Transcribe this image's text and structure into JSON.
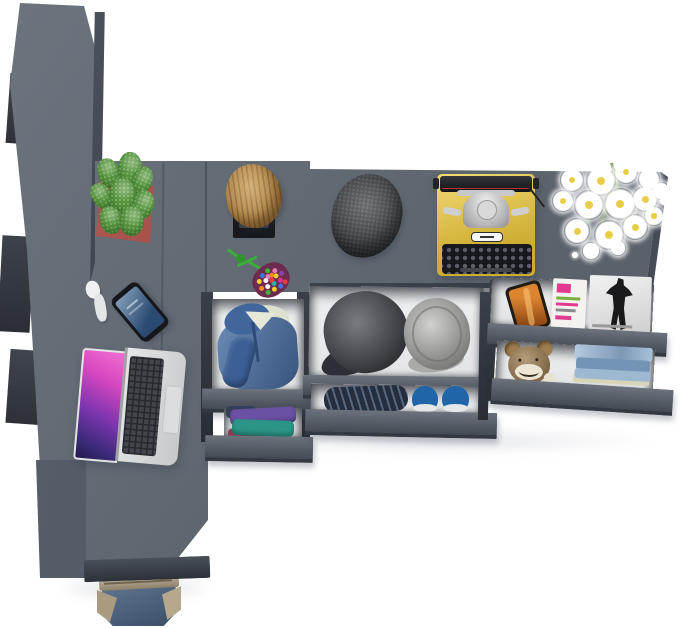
{
  "scene": {
    "type": "3d-furniture-render-top-view",
    "description": "Top-down render of a gray modular wardrobe and desk system with open drawers, clothing and desk accessories",
    "background": "#ffffff"
  },
  "colors": {
    "furniture_top": "#5d6671",
    "furniture_front": "#565e6a",
    "furniture_side": "#454c57",
    "furniture_dark_edge": "#3a414c",
    "drawer_interior": "#eef0f1",
    "typewriter_yellow": "#efc93a",
    "typewriter_keys": "#17191d",
    "pot_red": "#a5372e",
    "cactus_green": "#55953c",
    "hoodie_blue": "#4a70a6",
    "hoodie_lining": "#dde1cf",
    "cloth_purple": "#6b51a4",
    "cloth_teal": "#2d9587",
    "cloth_maroon": "#8e3c50",
    "cloth_navy": "#333f5c",
    "cap_dark": "#3f434a",
    "cap_gray": "#bdbdbb",
    "jeans_roll_dark": "#262d3d",
    "sneaker_blue": "#1f65a8",
    "sneaker_sole": "#e5e7e8",
    "teddy_brown": "#9c7c50",
    "teddy_muzzle": "#ece6d4",
    "jeans_stack_light": "#93b3d0",
    "magazine_orange": "#c9671a",
    "magazine_pink": "#e23a8e",
    "magazine_green": "#7ab03c",
    "magazine_bw_dark": "#1a1a1c",
    "beanie_charcoal": "#45484e",
    "stool_wood": "#b4894e",
    "chair_black": "#17191d",
    "keychain_green": "#3bad3b",
    "keychain_pouch": "#6e2b50",
    "laptop_silver": "#d6d8d9",
    "laptop_screen_magenta": "#d646c0",
    "laptop_screen_purple": "#5a2ea0",
    "phone_screen_blue": "#3d6a92",
    "bag_denim": "#4d6787",
    "bag_tan": "#b0a184",
    "bag_strap_red": "#d8434e",
    "flower_white": "#ffffff",
    "flower_center": "#e9cd4a"
  },
  "items": [
    {
      "id": "wardrobe-side-panel",
      "label": "tall wardrobe side panel"
    },
    {
      "id": "desk-surface",
      "label": "corner desk top"
    },
    {
      "id": "top-shelf",
      "label": "upper shelf unit"
    },
    {
      "id": "potted-cactus",
      "label": "cactus in red planter"
    },
    {
      "id": "wooden-stool",
      "label": "wooden log stool on black chair"
    },
    {
      "id": "bead-keychain",
      "label": "green cord with bead pouch"
    },
    {
      "id": "wool-flat-cap",
      "label": "dark wool flat cap"
    },
    {
      "id": "typewriter",
      "label": "yellow vintage typewriter"
    },
    {
      "id": "daisy-bouquet",
      "label": "white daisy bouquet"
    },
    {
      "id": "smartphone",
      "label": "smartphone on desk"
    },
    {
      "id": "earphones",
      "label": "white earphones"
    },
    {
      "id": "laptop",
      "label": "open laptop with purple wallpaper"
    },
    {
      "id": "hoodie-drawer",
      "label": "open drawer with denim hoodie"
    },
    {
      "id": "folded-clothes-drawer",
      "label": "drawer with folded shirts"
    },
    {
      "id": "caps-drawer",
      "label": "drawer with two caps"
    },
    {
      "id": "jeans-shoes-drawer",
      "label": "drawer with rolled jeans and blue sneakers"
    },
    {
      "id": "magazine-shelf",
      "label": "shelf with phone and magazines"
    },
    {
      "id": "teddy-drawer",
      "label": "drawer with teddy bear and folded jeans"
    },
    {
      "id": "tote-bag",
      "label": "denim tote bag with red straps"
    }
  ]
}
